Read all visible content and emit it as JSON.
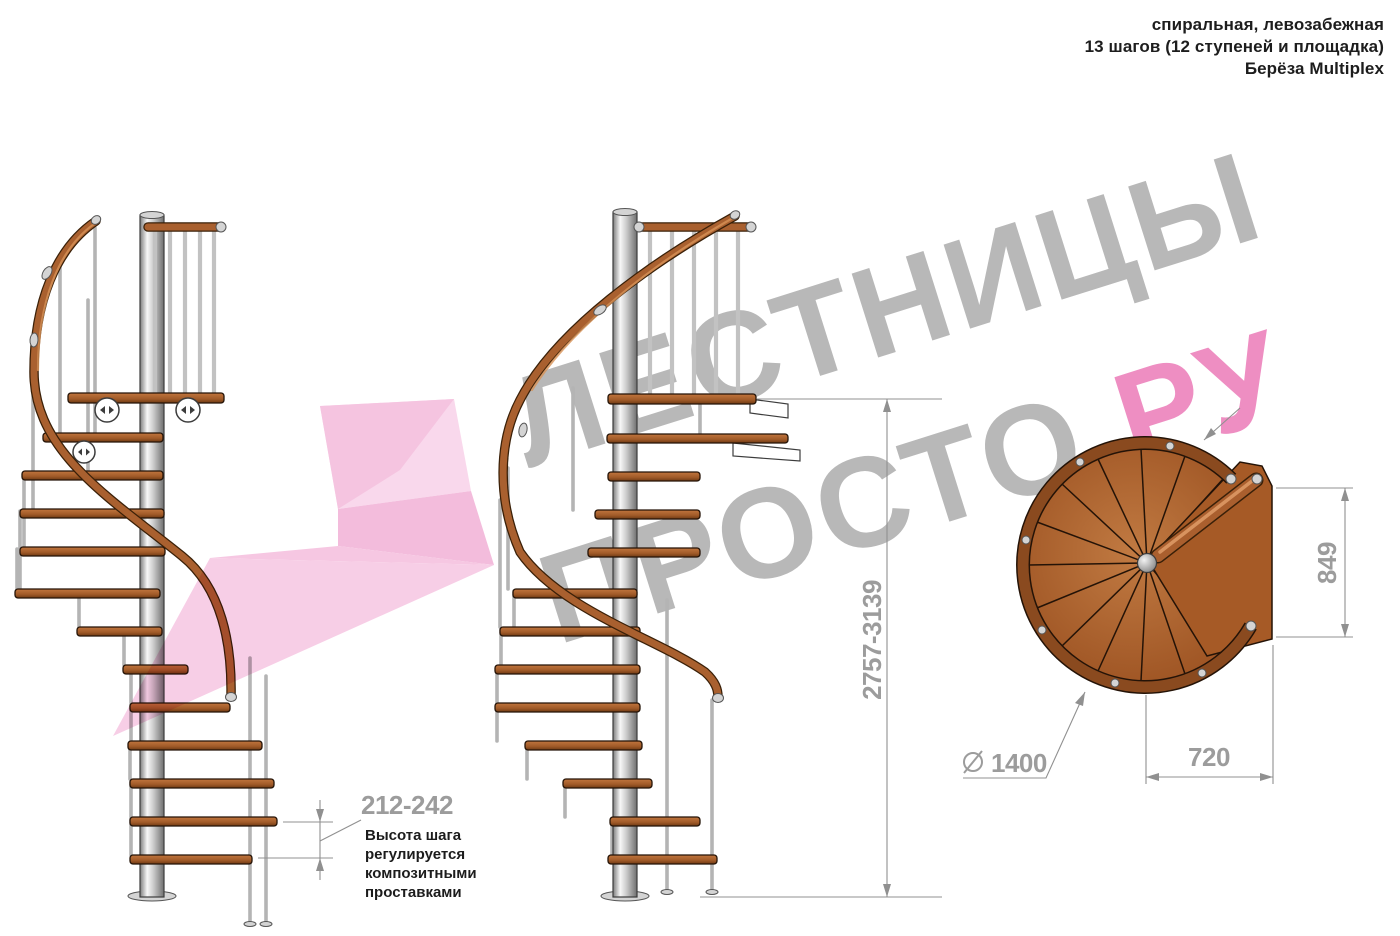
{
  "header": {
    "line1": "спиральная, левозабежная",
    "line2": "13 шагов (12 ступеней и площадка)",
    "line3": "Берёза Multiplex"
  },
  "watermark": {
    "line1": "ЛЕСТНИЦЫ",
    "line2": "ПРОСТО",
    "line2_suffix": ".РУ",
    "gray_color": "#b8b8b8",
    "pink_color": "#ee8ec2",
    "arrow_pink_color": "#f3afd6"
  },
  "dimensions": {
    "total_height_range": "2757-3139",
    "platform_depth": "849",
    "platform_width": "720",
    "diameter_symbol": "⌀",
    "diameter_value": "1400",
    "step_height_range": "212-242"
  },
  "note": {
    "line1": "Высота шага",
    "line2": "регулируется",
    "line3": "композитными",
    "line4": "проставками"
  },
  "materials": {
    "wood_color": "#a55e2a",
    "handrail_color": "#a9602f",
    "pole_color": "#cfcfcf",
    "dimension_color": "#9c9c9c"
  }
}
